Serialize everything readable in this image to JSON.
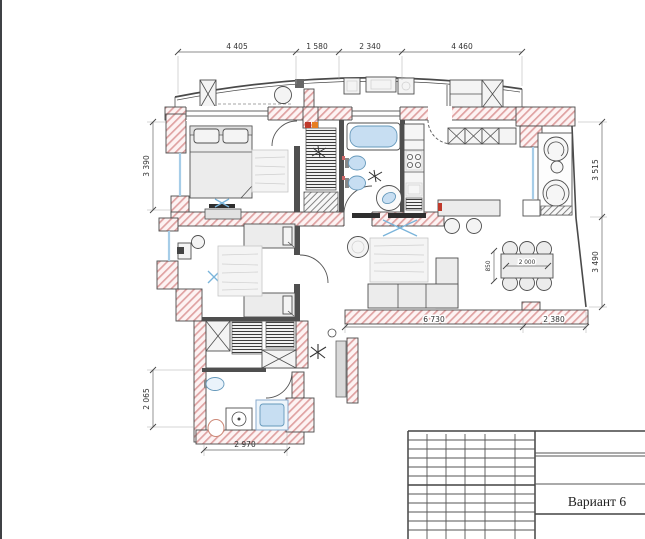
{
  "drawing": {
    "type": "apartment-floor-plan",
    "title_block": {
      "variant_label": "Вариант 6"
    },
    "dimensions": {
      "top": [
        "4 405",
        "1 580",
        "2 340",
        "4 460"
      ],
      "left": [
        "3 390",
        "2 065"
      ],
      "right": [
        "3 515",
        "3 490"
      ],
      "bottom": [
        "6 730",
        "2 380"
      ],
      "bottom_left": "2 970",
      "dining_table": {
        "length": "2 000",
        "width": "850"
      }
    },
    "colors": {
      "wall_hatch_stroke": "#dfa2a2",
      "wall_fill": "#fdf3f3",
      "outline": "#4a4a4a",
      "fixture_fill": "#c7def2",
      "fixture_stroke": "#6699bb",
      "window_glass": "#a6cde8",
      "tv_mark": "#7ab4da",
      "furniture_fill": "#ececec",
      "dim_text": "#333333"
    }
  }
}
